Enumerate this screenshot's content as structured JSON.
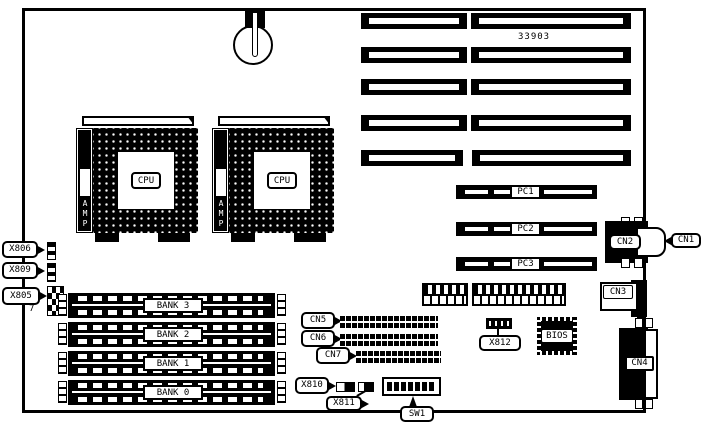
{
  "board": {
    "part_number": "33903"
  },
  "cpu": {
    "label": "CPU",
    "brand": "AMP"
  },
  "pci_slots": [
    "PC1",
    "PC2",
    "PC3"
  ],
  "memory_banks": [
    "BANK 3",
    "BANK 2",
    "BANK 1",
    "BANK 0"
  ],
  "connectors": {
    "cn1": "CN1",
    "cn2": "CN2",
    "cn3": "CN3",
    "cn4": "CN4",
    "cn5": "CN5",
    "cn6": "CN6",
    "cn7": "CN7"
  },
  "jumpers": {
    "x805": "X805",
    "x806": "X806",
    "x809": "X809",
    "x810": "X810",
    "x811": "X811",
    "x812": "X812",
    "pin_label": "7"
  },
  "switches": {
    "sw1": "SW1"
  },
  "chips": {
    "bios": "BIOS"
  }
}
